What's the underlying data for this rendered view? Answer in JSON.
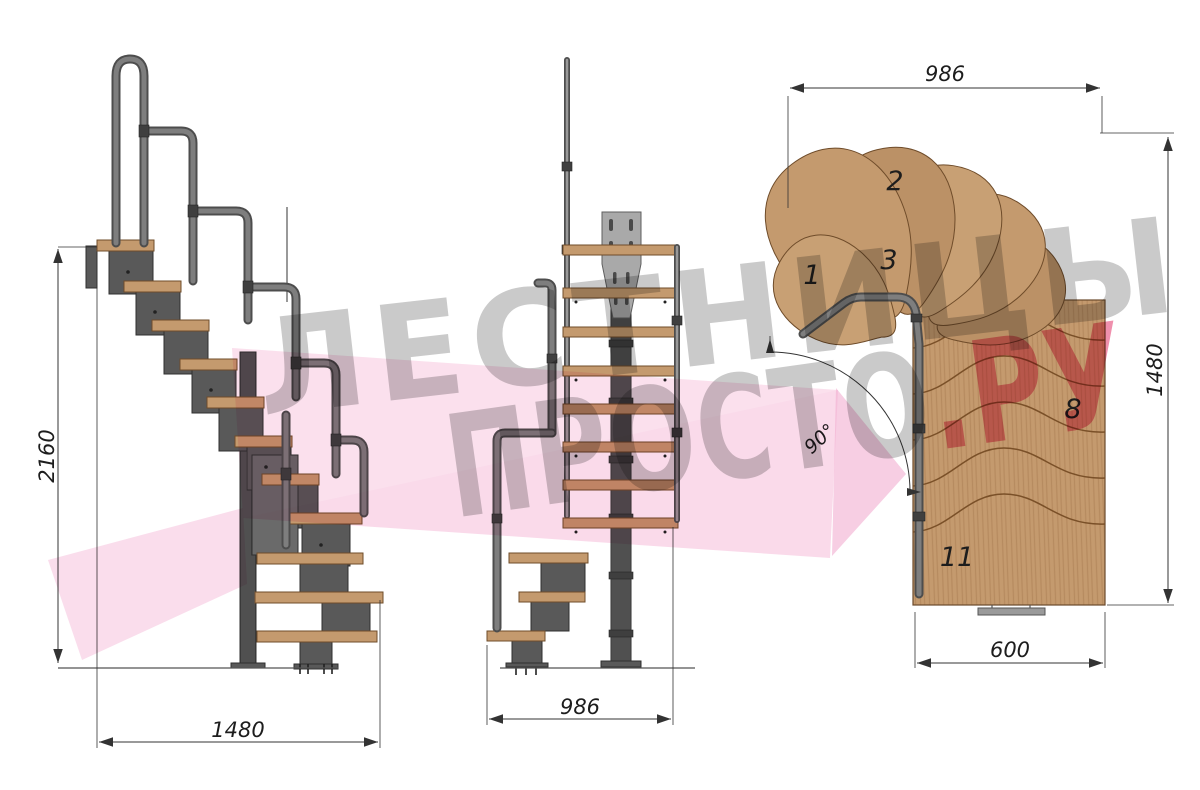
{
  "title": "Staircase technical drawing",
  "watermark": {
    "line1": "ЛЕСТНИЦЫ",
    "line2_gray": "ПРОСТО",
    "line2_pink": ".РУ"
  },
  "side_view": {
    "dim_height": "2160",
    "dim_length": "1480"
  },
  "front_view": {
    "dim_width": "986"
  },
  "plan_view": {
    "dim_width_top": "986",
    "dim_height_right": "1480",
    "dim_width_bottom": "600",
    "angle_label": "90°",
    "step_1": "1",
    "step_2": "2",
    "step_3": "3",
    "step_8": "8",
    "step_11": "11"
  },
  "colors": {
    "wood": "#c49a6e",
    "wood_edge": "#6f4c2a",
    "metal": "#595959",
    "metal_edge": "#2f2f2f",
    "pipe": "#4d4d4d",
    "pipe_light": "#7e7e7e",
    "plate": "#a9a9a9",
    "line": "#333333",
    "watermark_gray": "#c6c6c6",
    "watermark_pink": "#ee86a6",
    "ribbon_pink": "#f5bcd9"
  }
}
